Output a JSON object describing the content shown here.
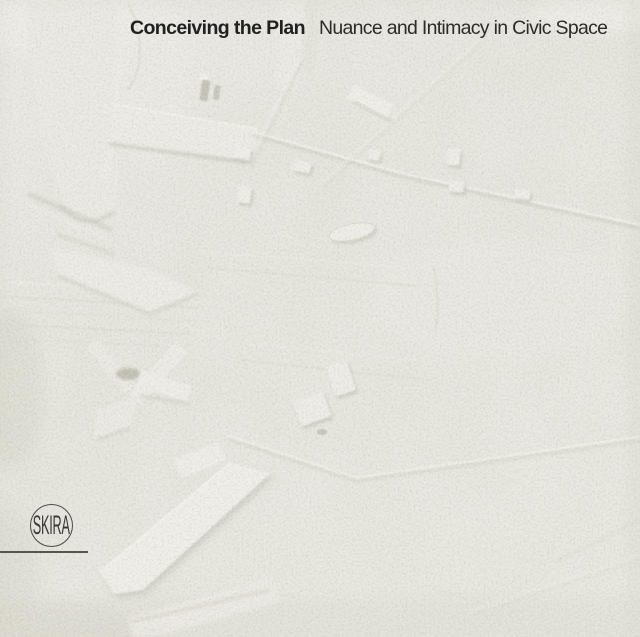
{
  "cover": {
    "title": "Conceiving the Plan",
    "subtitle": "Nuance and Intimacy in Civic Space",
    "publisher": "SKIRA",
    "colors": {
      "background": "#e7e6de",
      "title_text": "#21211e",
      "subtitle_text": "#2c2b27",
      "logo": "#3a3934",
      "relief_highlight": "#f6f5ef",
      "relief_shadow": "#c7c5b9"
    },
    "artwork_alt": "white plaster bas-relief of an urban plan"
  }
}
